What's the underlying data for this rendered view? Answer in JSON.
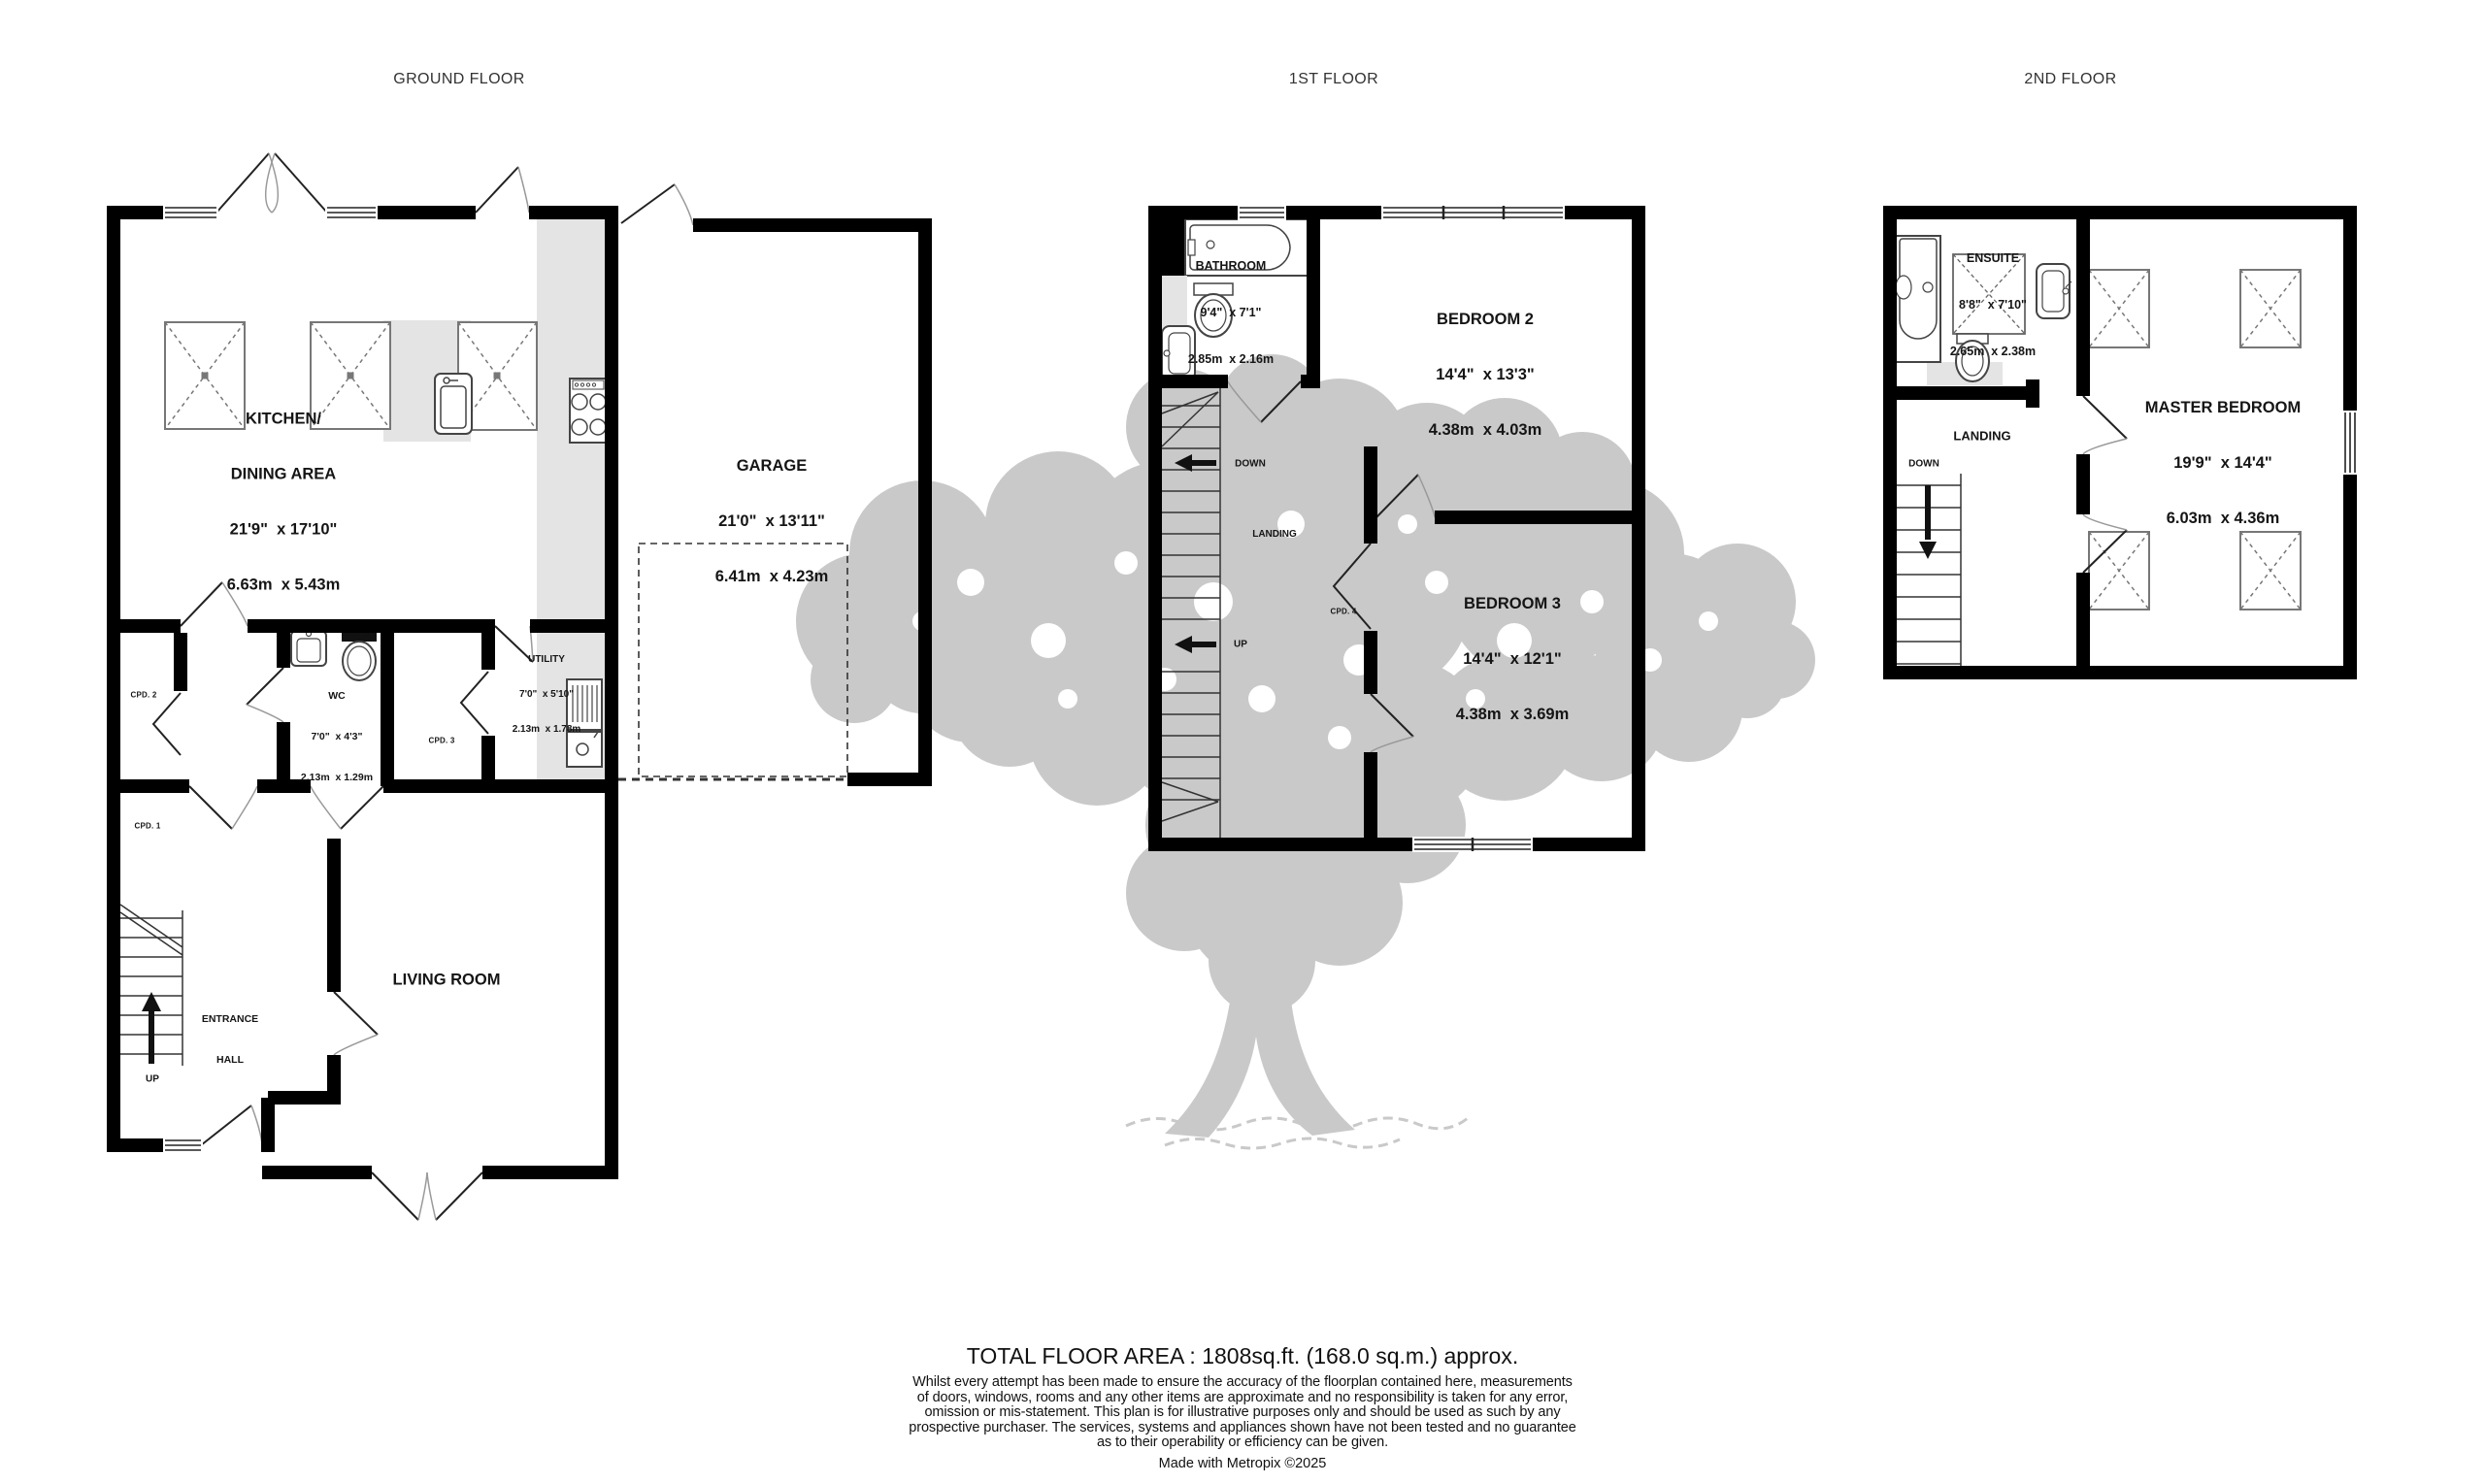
{
  "floors": {
    "ground": {
      "title": "GROUND FLOOR",
      "kitchen": {
        "name1": "KITCHEN/",
        "name2": "DINING AREA",
        "imperial": "21'9\"  x 17'10\"",
        "metric": "6.63m  x 5.43m"
      },
      "garage": {
        "name": "GARAGE",
        "imperial": "21'0\"  x 13'11\"",
        "metric": "6.41m  x 4.23m"
      },
      "wc": {
        "name": "WC",
        "imperial": "7'0\"  x 4'3\"",
        "metric": "2.13m  x 1.29m"
      },
      "utility": {
        "name": "UTILITY",
        "imperial": "7'0\"  x 5'10\"",
        "metric": "2.13m  x 1.78m"
      },
      "cpd1": "CPD. 1",
      "cpd2": "CPD. 2",
      "cpd3": "CPD. 3",
      "entrance1": "ENTRANCE",
      "entrance2": "HALL",
      "living": "LIVING ROOM",
      "up": "UP"
    },
    "first": {
      "title": "1ST FLOOR",
      "bathroom": {
        "name": "BATHROOM",
        "imperial": "9'4\"  x 7'1\"",
        "metric": "2.85m  x 2.16m"
      },
      "bedroom2": {
        "name": "BEDROOM 2",
        "imperial": "14'4\"  x 13'3\"",
        "metric": "4.38m  x 4.03m"
      },
      "bedroom3": {
        "name": "BEDROOM 3",
        "imperial": "14'4\"  x 12'1\"",
        "metric": "4.38m  x 3.69m"
      },
      "landing": "LANDING",
      "cpd4": "CPD. 4",
      "down": "DOWN",
      "up": "UP"
    },
    "second": {
      "title": "2ND FLOOR",
      "ensuite": {
        "name": "ENSUITE",
        "imperial": "8'8\"  x 7'10\"",
        "metric": "2.65m  x 2.38m"
      },
      "master": {
        "name": "MASTER BEDROOM",
        "imperial": "19'9\"  x 14'4\"",
        "metric": "6.03m  x 4.36m"
      },
      "landing": "LANDING",
      "down": "DOWN"
    }
  },
  "footer": {
    "total": "TOTAL FLOOR AREA : 1808sq.ft. (168.0 sq.m.) approx.",
    "disclaimer": [
      "Whilst every attempt has been made to ensure the accuracy of the floorplan contained here, measurements",
      "of doors, windows, rooms and any other items are approximate and no responsibility is taken for any error,",
      "omission or mis-statement. This plan is for illustrative purposes only and should be used as such by any",
      "prospective purchaser. The services, systems and appliances shown have not been tested and no guarantee",
      "as to their operability or efficiency can be given."
    ],
    "credit": "Made with Metropix ©2025"
  },
  "colors": {
    "wall": "#000000",
    "counter": "#e4e4e4",
    "tree": "#c9c9c9",
    "text": "#151515"
  }
}
